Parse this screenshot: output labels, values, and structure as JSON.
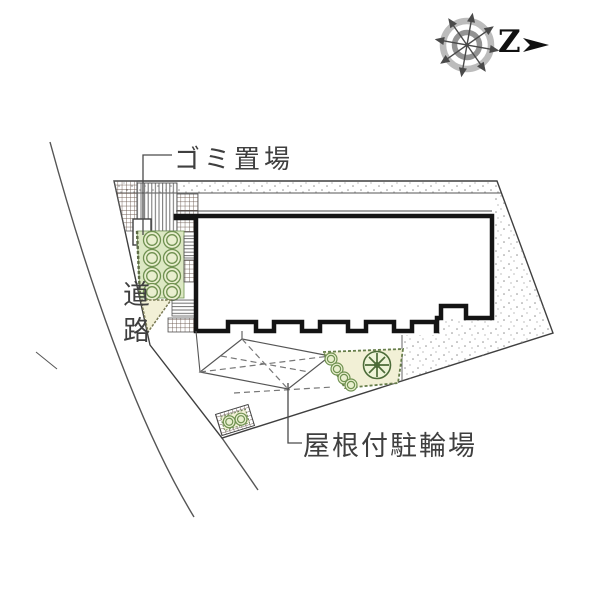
{
  "labels": {
    "garbage": "ゴミ置場",
    "road": "道路",
    "bicycle_parking": "屋根付駐輪場"
  },
  "compass": {
    "letter": "Z"
  },
  "colors": {
    "outline": "#3f3f3f",
    "building_outline": "#141414",
    "crosshatch": "#6d5b52",
    "stripe": "#6f6f6f",
    "planting_bg": "#dce8c3",
    "planting_edge": "#6f9150",
    "cream": "#f2f0d6",
    "stipple": "#909090",
    "compass_gray": "#bcbcbc"
  }
}
